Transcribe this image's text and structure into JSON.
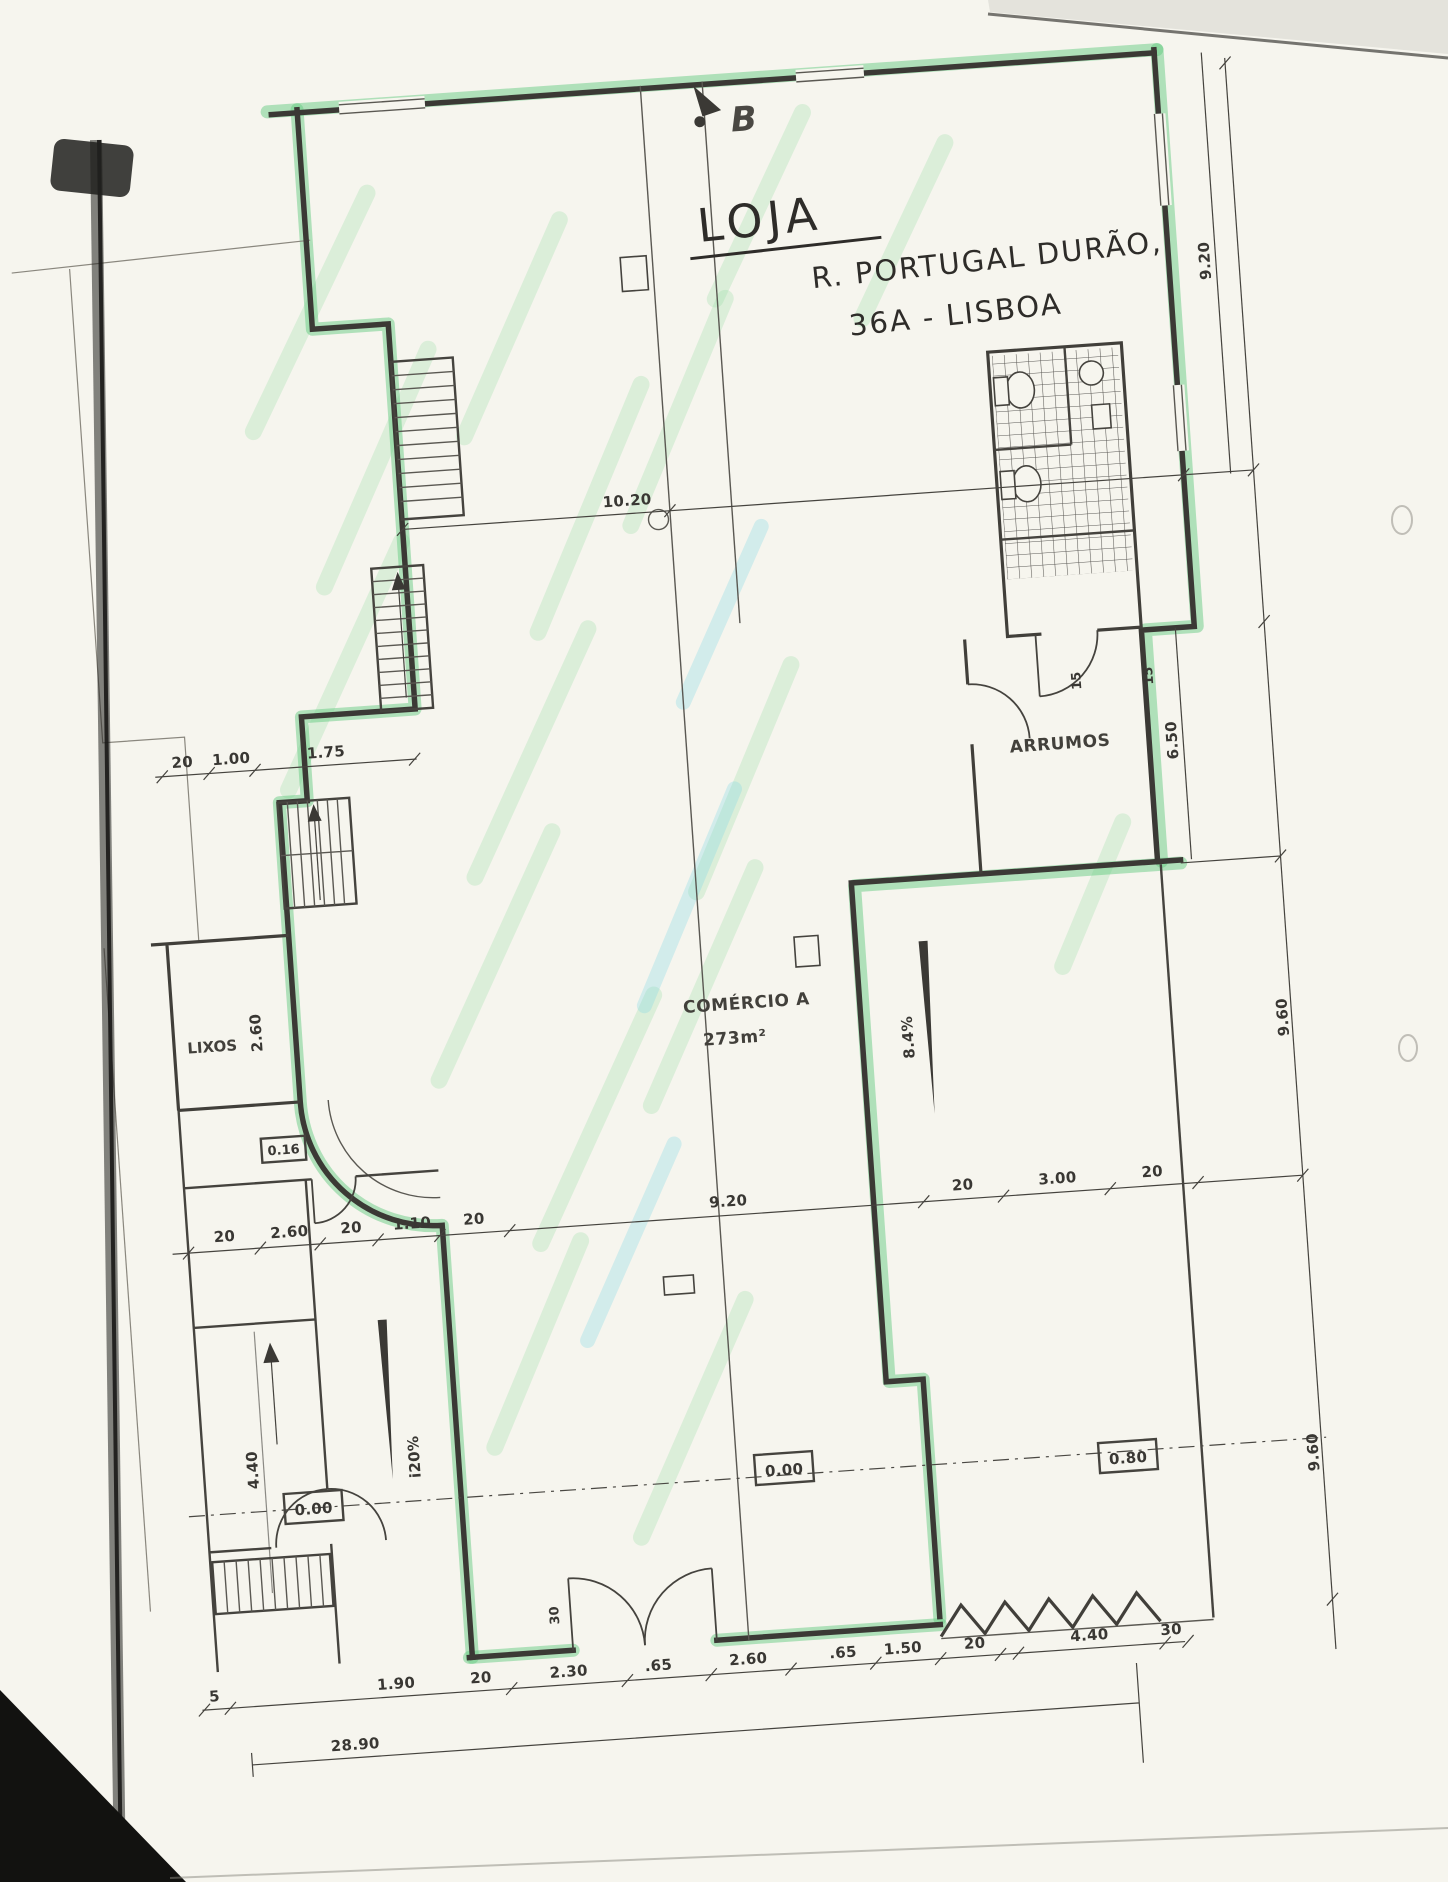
{
  "document": {
    "kind": "scanned floor plan with highlighter markup"
  },
  "hand": {
    "title": "LOJA",
    "addr1": "R. PORTUGAL DURÃO,",
    "addr2": "36A - LISBOA"
  },
  "marker": {
    "b": "B"
  },
  "rooms": {
    "arrumos": "ARRUMOS",
    "comercio": "COMÉRCIO A",
    "comercio_area": "273m²",
    "lixos": "LIXOS"
  },
  "dims": {
    "top": "10.20",
    "middle": [
      "20",
      "2.60",
      "20",
      "1.10",
      "20",
      "9.20",
      "20",
      "3.00",
      "20"
    ],
    "bottom": [
      "5",
      "1.90",
      "20",
      "2.30",
      ".65",
      "2.60",
      ".65",
      "1.50",
      "20",
      "4.40",
      "30"
    ],
    "bottom_total": "28.90",
    "left_stair": [
      "20",
      "1.00",
      "1.75"
    ],
    "right": [
      "9.20",
      "6.50",
      "9.60",
      "9.60"
    ],
    "lixos_depth": "2.60",
    "stair_width": "4.40",
    "bath_door": [
      "15",
      "15"
    ],
    "door_width": "30"
  },
  "levels": {
    "a": "0.00",
    "b": "0.00",
    "c": "0.80",
    "d": "0.16"
  },
  "slopes": {
    "left_ramp": "i20%",
    "right_ramp": "8.4%"
  },
  "colors": {
    "paper": "#f6f5ee",
    "ink": "#3b3935",
    "highlighter": "#6ecd87",
    "streak_green": "#8fdca0",
    "streak_cyan": "#7fd8e4"
  }
}
